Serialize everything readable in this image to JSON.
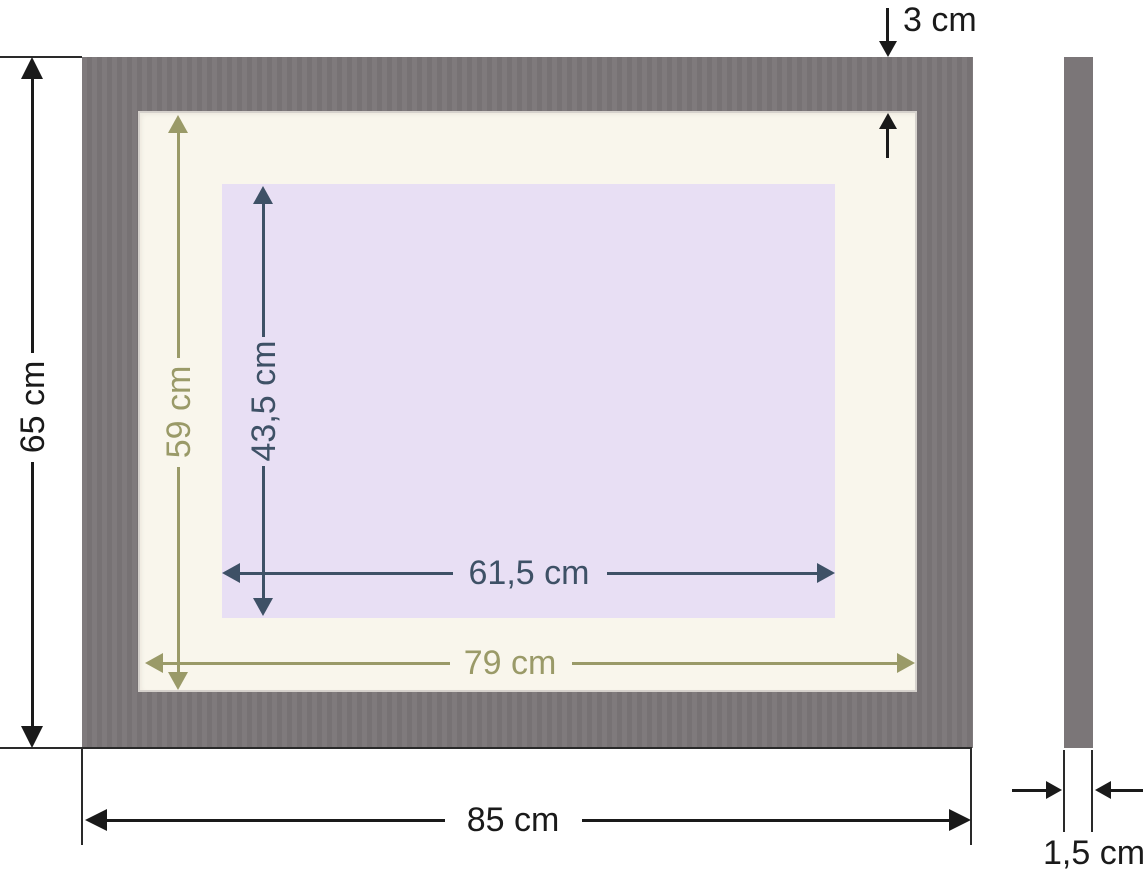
{
  "diagram": {
    "front_view": {
      "outer_height_label": "65 cm",
      "outer_width_label": "85 cm",
      "frame_border_label": "3 cm",
      "mat_height_label": "59 cm",
      "mat_width_label": "79 cm",
      "opening_height_label": "43,5 cm",
      "opening_width_label": "61,5 cm"
    },
    "side_view": {
      "thickness_label": "1,5 cm"
    },
    "colors": {
      "frame_gray": "#7b7678",
      "mat_cream": "#f9f6ec",
      "opening_lavender": "#e8dff4",
      "dimension_black": "#1a1a1a",
      "dimension_olive": "#9a9a68",
      "dimension_slate": "#3e5166",
      "background": "#ffffff"
    }
  }
}
